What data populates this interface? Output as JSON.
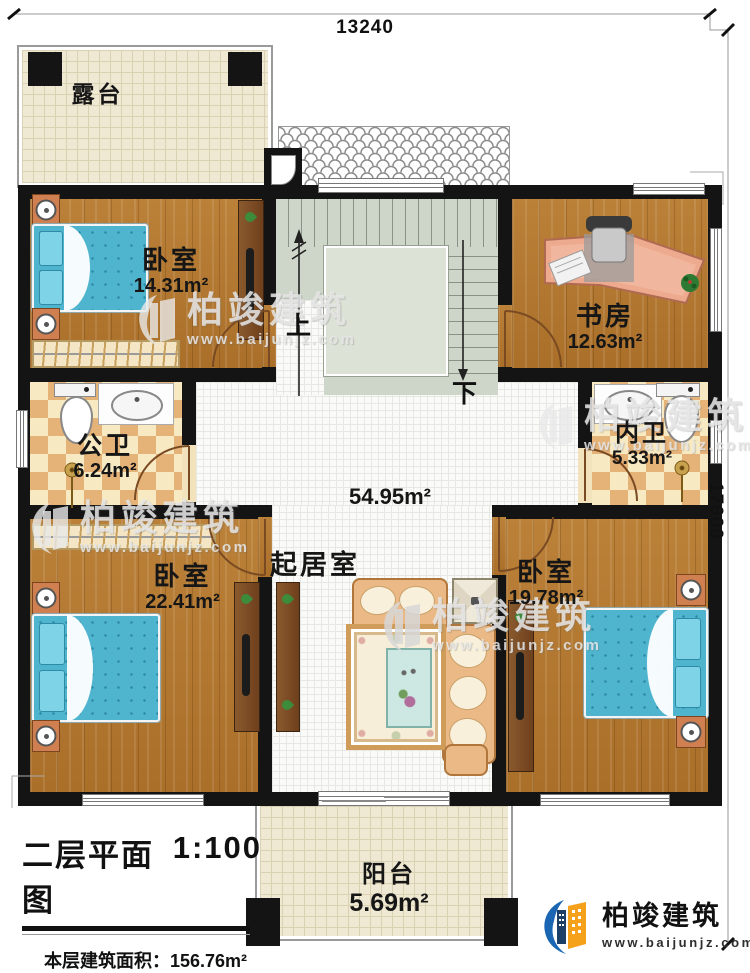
{
  "title_block": {
    "title": "二层平面图",
    "scale": "1:100",
    "area_label": "本层建筑面积：",
    "area_value": "156.76m²",
    "height_label": "层高:",
    "height_value": "3.3m"
  },
  "dimensions": {
    "width": "13240",
    "height": "17600"
  },
  "rooms": {
    "terrace": {
      "name": "露台"
    },
    "bedroom_top_left": {
      "name": "卧室",
      "area": "14.31m²"
    },
    "study": {
      "name": "书房",
      "area": "12.63m²"
    },
    "public_bath": {
      "name": "公卫",
      "area": "6.24m²"
    },
    "ensuite_bath": {
      "name": "内卫",
      "area": "5.33m²"
    },
    "living": {
      "name": "起居室",
      "area": "54.95m²"
    },
    "bedroom_bottom_left": {
      "name": "卧室",
      "area": "22.41m²"
    },
    "bedroom_bottom_right": {
      "name": "卧室",
      "area": "19.78m²"
    },
    "balcony": {
      "name": "阳台",
      "area": "5.69m²"
    }
  },
  "stairs": {
    "up": "上",
    "down": "下"
  },
  "watermark": {
    "brand": "柏竣建筑",
    "site": "www.baijunjz.com"
  },
  "logo": {
    "brand": "柏竣建筑",
    "site": "www.baijunjz.com"
  },
  "palette": {
    "wall": "#141414",
    "wood_floor": "#b57b33",
    "bath_tile": "#e5b277",
    "stair_floor": "#ced5c9",
    "terrace_tile": "#efe9d3",
    "living_floor": "#fafaf8",
    "bed": "#4fb5cf",
    "logo_blue": "#1a66b3",
    "logo_orange": "#f5a11c"
  }
}
